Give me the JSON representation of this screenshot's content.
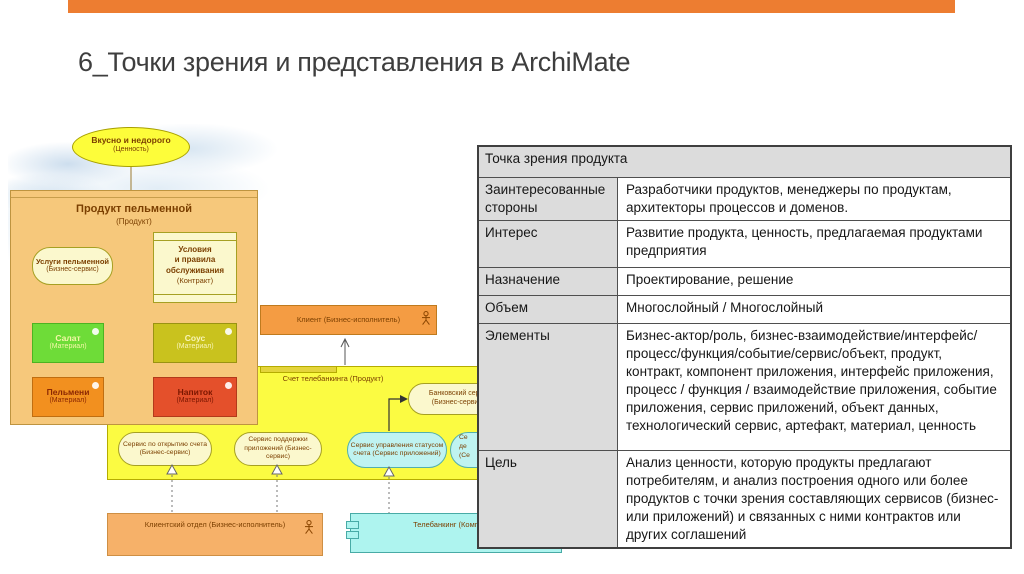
{
  "slide": {
    "title": "6_Точки зрения и представления в ArchiMate",
    "accent_color": "#ED7D31"
  },
  "diagram": {
    "value_ellipse": {
      "name": "Вкусно и недорого",
      "type": "(Ценность)"
    },
    "product_box": {
      "name": "Продукт пельменной",
      "type": "(Продукт)"
    },
    "business_service": {
      "name": "Услуги пельменной",
      "type": "(Бизнес-сервис)"
    },
    "contract": {
      "lines": [
        "Условия",
        "и правила",
        "обслуживания"
      ],
      "type": "(Контракт)"
    },
    "materials": [
      {
        "name": "Салат",
        "type": "(Материал)"
      },
      {
        "name": "Соус",
        "type": "(Материал)"
      },
      {
        "name": "Пельмени",
        "type": "(Материал)"
      },
      {
        "name": "Напиток",
        "type": "(Материал)"
      }
    ],
    "client": {
      "name": "Клиент (Бизнес-исполнитель)"
    },
    "account_box": {
      "label": "Счет телебанкинга (Продукт)"
    },
    "bank_service": {
      "name": "Банковский серви",
      "type": "(Бизнес-сервис)"
    },
    "services": [
      {
        "name": "Сервис по открытию счета (Бизнес-сервис)"
      },
      {
        "name": "Сервис поддержки приложений (Бизнес-сервис)"
      },
      {
        "name": "Сервис управления статусом счета (Сервис приложений)"
      },
      {
        "lines": [
          "Се",
          "де",
          "(Се"
        ]
      }
    ],
    "client_department": {
      "name": "Клиентский отдел (Бизнес-исполнитель)"
    },
    "telebanking": {
      "name": "Телебанкинг (Компонент"
    }
  },
  "table": {
    "header": "Точка зрения продукта",
    "rows": [
      {
        "label": "Заинтересованные стороны",
        "value": "Разработчики продуктов, менеджеры по продуктам, архитекторы процессов и доменов."
      },
      {
        "label": "Интерес",
        "value": "Развитие продукта, ценность, предлагаемая продуктами предприятия"
      },
      {
        "label": "Назначение",
        "value": "Проектирование, решение"
      },
      {
        "label": "Объем",
        "value": "Многослойный / Многослойный"
      },
      {
        "label": "Элементы",
        "value": "Бизнес-актор/роль, бизнес-взаимодействие/интерфейс/процесс/функция/событие/сервис/объект, продукт, контракт, компонент приложения, интерфейс приложения, процесс / функция / взаимодействие приложения, событие приложения, сервис приложений, объект данных, технологический сервис, артефакт, материал, ценность"
      },
      {
        "label": "Цель",
        "value": "Анализ ценности, которую продукты предлагают потребителям, и анализ построения одного или более продуктов с точки зрения составляющих сервисов (бизнес- или приложений) и связанных с ними контрактов или других соглашений"
      }
    ]
  }
}
